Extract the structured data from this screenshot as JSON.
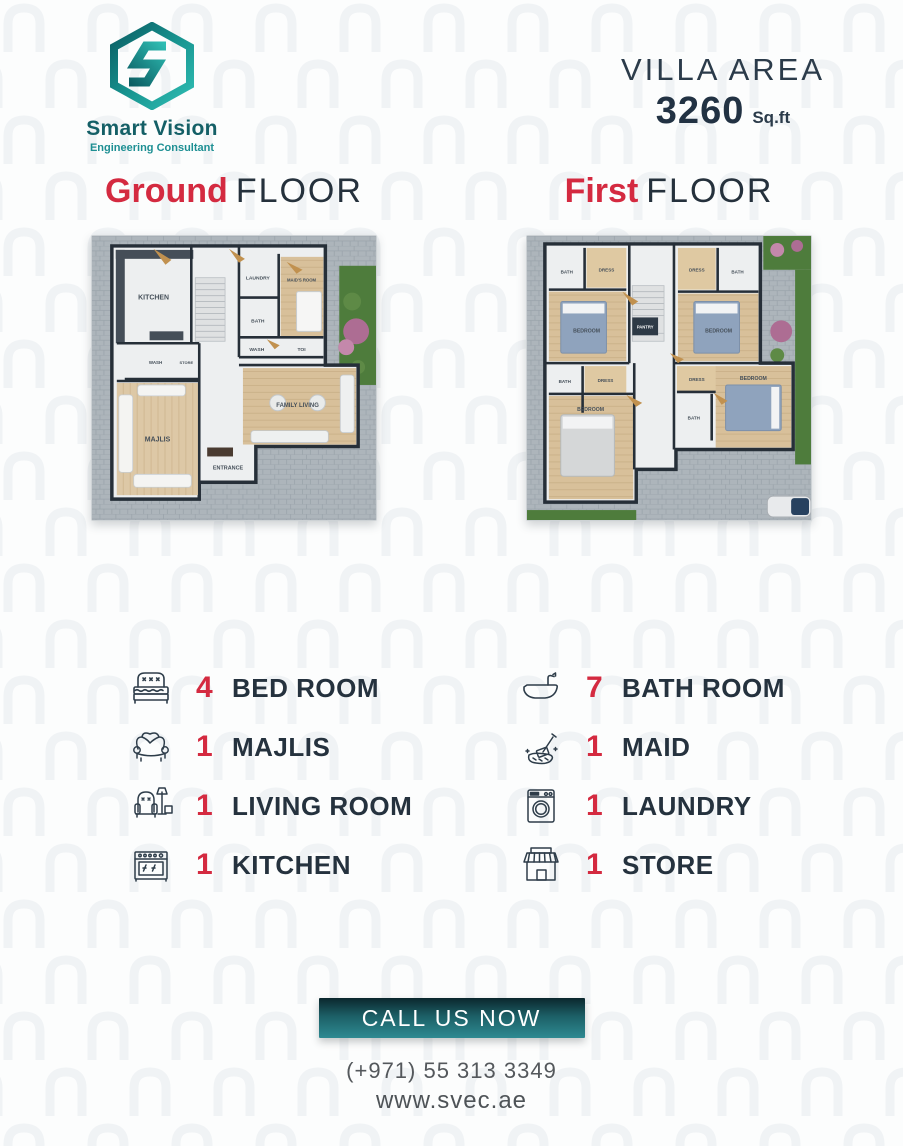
{
  "brand": {
    "name": "Smart Vision",
    "tagline": "Engineering Consultant"
  },
  "villa": {
    "label": "VILLA AREA",
    "area": "3260",
    "unit": "Sq.ft"
  },
  "floors": [
    {
      "highlight": "Ground",
      "word": "FLOOR"
    },
    {
      "highlight": "First",
      "word": "FLOOR"
    }
  ],
  "plans": {
    "ground": {
      "rooms": [
        "KITCHEN",
        "LAUNDRY",
        "MAID'S ROOM",
        "BATH",
        "WASH",
        "TOI",
        "WASH",
        "STORE",
        "MAJLIS",
        "FAMILY LIVING",
        "ENTRANCE"
      ]
    },
    "first": {
      "rooms": [
        "BATH",
        "DRESS",
        "BEDROOM",
        "DRESS",
        "BATH",
        "BEDROOM",
        "PANTRY",
        "BATH",
        "DRESS",
        "BEDROOM",
        "DRESS",
        "BATH",
        "BEDROOM"
      ]
    }
  },
  "features": {
    "left": [
      {
        "count": "4",
        "label": "BED ROOM",
        "icon": "bed-icon"
      },
      {
        "count": "1",
        "label": "MAJLIS",
        "icon": "sofa-icon"
      },
      {
        "count": "1",
        "label": "LIVING ROOM",
        "icon": "armchair-icon"
      },
      {
        "count": "1",
        "label": "KITCHEN",
        "icon": "stove-icon"
      }
    ],
    "right": [
      {
        "count": "7",
        "label": "BATH ROOM",
        "icon": "bathtub-icon"
      },
      {
        "count": "1",
        "label": "MAID",
        "icon": "cleaning-icon"
      },
      {
        "count": "1",
        "label": "LAUNDRY",
        "icon": "washing-machine-icon"
      },
      {
        "count": "1",
        "label": "STORE",
        "icon": "storefront-icon"
      }
    ]
  },
  "cta": {
    "label": "CALL US NOW"
  },
  "contact": {
    "phone": "(+971) 55 313 3349",
    "website": "www.svec.ae"
  },
  "colors": {
    "accent_red": "#d42a40",
    "navy": "#25323e",
    "teal": "#128286",
    "teal_dark": "#0c2e34"
  }
}
